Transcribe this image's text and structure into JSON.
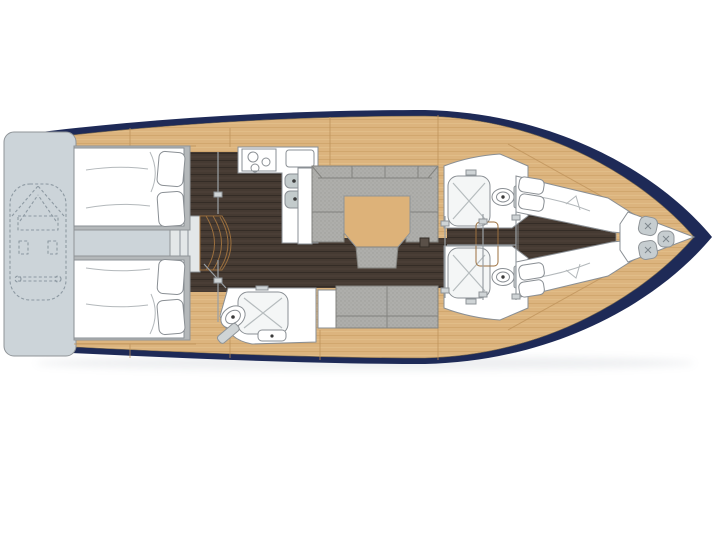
{
  "diagram": {
    "type": "yacht-interior-floor-plan",
    "background": "#ffffff",
    "colors": {
      "hull": "#1e2a57",
      "deck_wood": "#dcb47e",
      "wood_seam": "#bd9159",
      "floor_dark": "#453a32",
      "floor_seam": "#2f2822",
      "platform": "#ccd4d9",
      "platform_outline": "#97a2aa",
      "landing": "#e3e7e8",
      "upholstery": "#aeaeab",
      "upholstery_outline": "#83837f",
      "fixture_white": "#ffffff",
      "fixture_outline": "#8a8f94",
      "sink_basin": "#c3cbcc",
      "shower_floor": "#f4f6f6",
      "table_wood": "#ddb279",
      "table_outline": "#b3884f",
      "bed_frame": "#b4b8ba",
      "fender": "#c6cdd0",
      "hatch": "#5a5048",
      "tank_gray": "#cfd4d6",
      "shadow": "#8a93a0"
    },
    "components": [
      {
        "id": "swim-platform",
        "label": "stern swim platform with dinghy (dashed outline)"
      },
      {
        "id": "aft-cabin-port",
        "label": "aft double-berth cabin, port"
      },
      {
        "id": "aft-cabin-starboard",
        "label": "aft double-berth cabin, starboard"
      },
      {
        "id": "companionway-steps",
        "label": "companionway steps"
      },
      {
        "id": "galley",
        "label": "L-shaped galley with 3-burner stove and twin sinks"
      },
      {
        "id": "aft-head",
        "label": "aft head with shower, toilet and sink"
      },
      {
        "id": "salon",
        "label": "salon with U-shaped sofa, table and stool"
      },
      {
        "id": "side-settee",
        "label": "straight settee opposite salon"
      },
      {
        "id": "head-port",
        "label": "midship head with shower and toilet, port"
      },
      {
        "id": "head-starboard",
        "label": "midship head with shower and toilet, starboard"
      },
      {
        "id": "bow-cabin",
        "label": "forward cabin with twin V-berths"
      },
      {
        "id": "anchor-locker",
        "label": "bow locker with three fenders"
      }
    ]
  }
}
